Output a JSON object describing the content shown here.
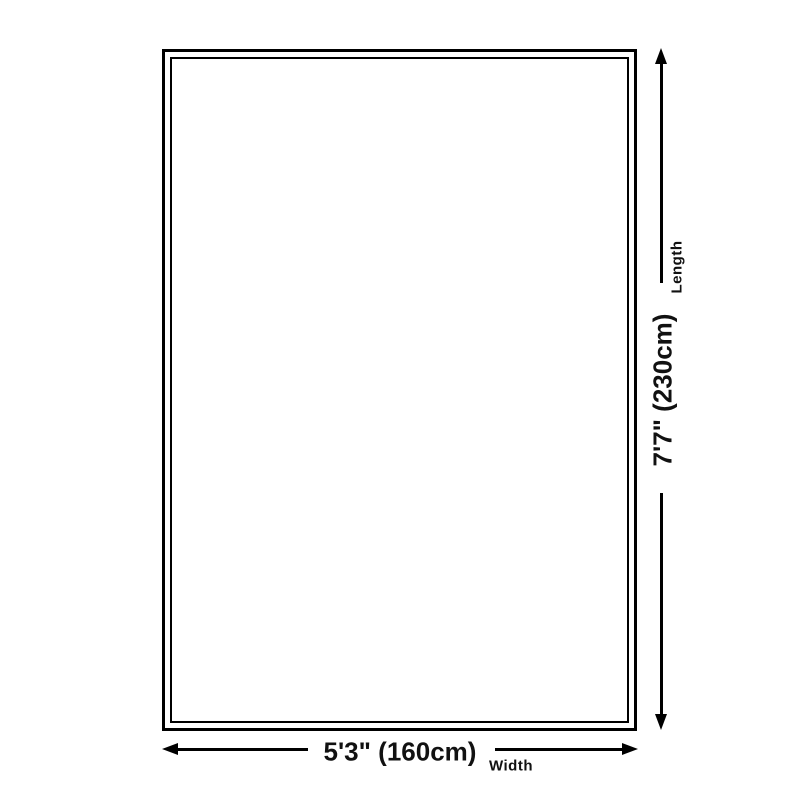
{
  "diagram": {
    "type": "product-dimension-diagram",
    "background_color": "#ffffff",
    "line_color": "#000000",
    "text_color": "#111111",
    "length_dimension": {
      "value": "7'7\" (230cm)",
      "label": "Length"
    },
    "width_dimension": {
      "value": "5'3\" (160cm)",
      "label": "Width"
    }
  }
}
